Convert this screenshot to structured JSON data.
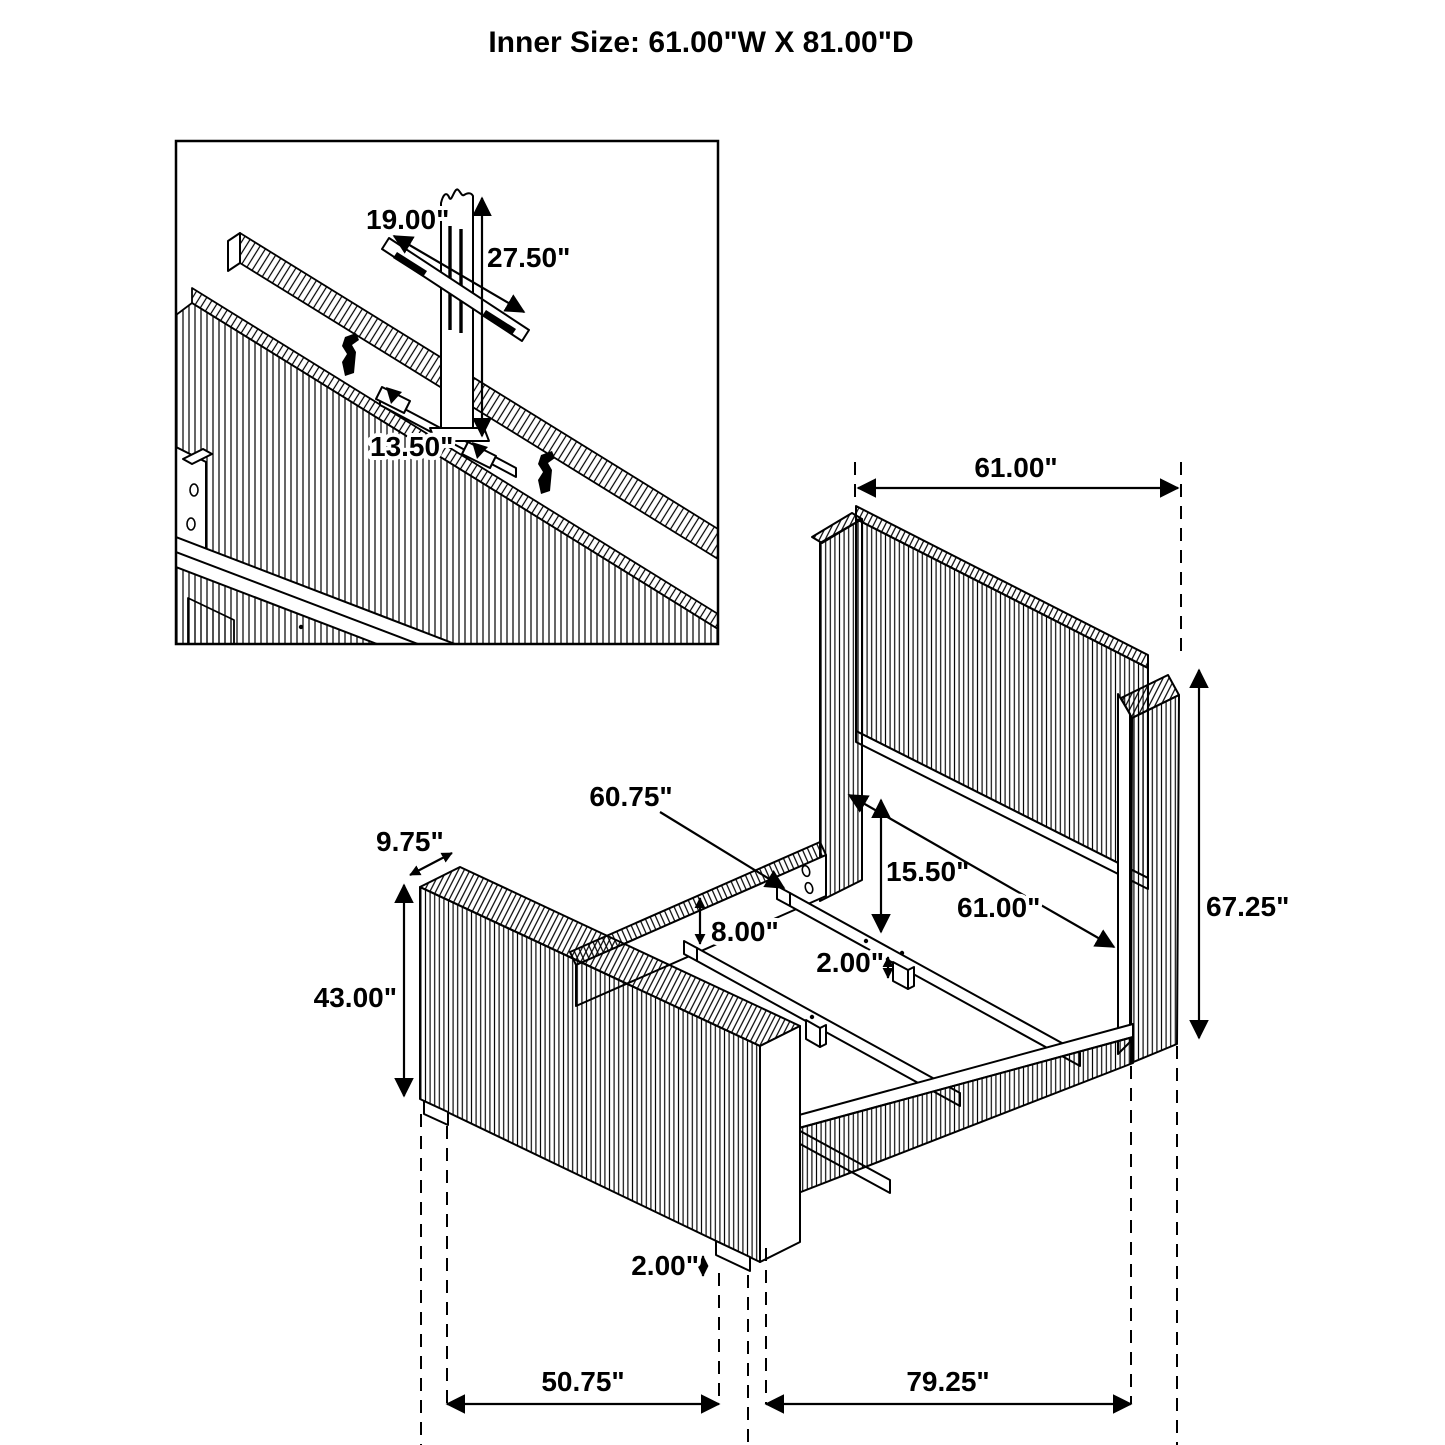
{
  "title": "Inner Size: 61.00\"W X 81.00\"D",
  "colors": {
    "line": "#000000",
    "background": "#ffffff"
  },
  "inset": {
    "description": "tv-mount-detail",
    "bracket_width": "19.00\"",
    "mount_height": "27.50\"",
    "bracket_length": "13.50\""
  },
  "bed": {
    "headboard_width": "61.00\"",
    "headboard_height": "67.25\"",
    "slat_length": "60.75\"",
    "footboard_depth": "9.75\"",
    "footboard_height": "43.00\"",
    "rail_to_slat_drop": "8.00\"",
    "headboard_panel_clearance": "15.50\"",
    "inner_width": "61.00\"",
    "slat_leg_height": "2.00\"",
    "footboard_leg_height": "2.00\"",
    "footboard_inner_span": "50.75\"",
    "rail_span": "79.25\"",
    "footboard_overall_width": "67.25\"",
    "overall_depth": "99.75\""
  }
}
